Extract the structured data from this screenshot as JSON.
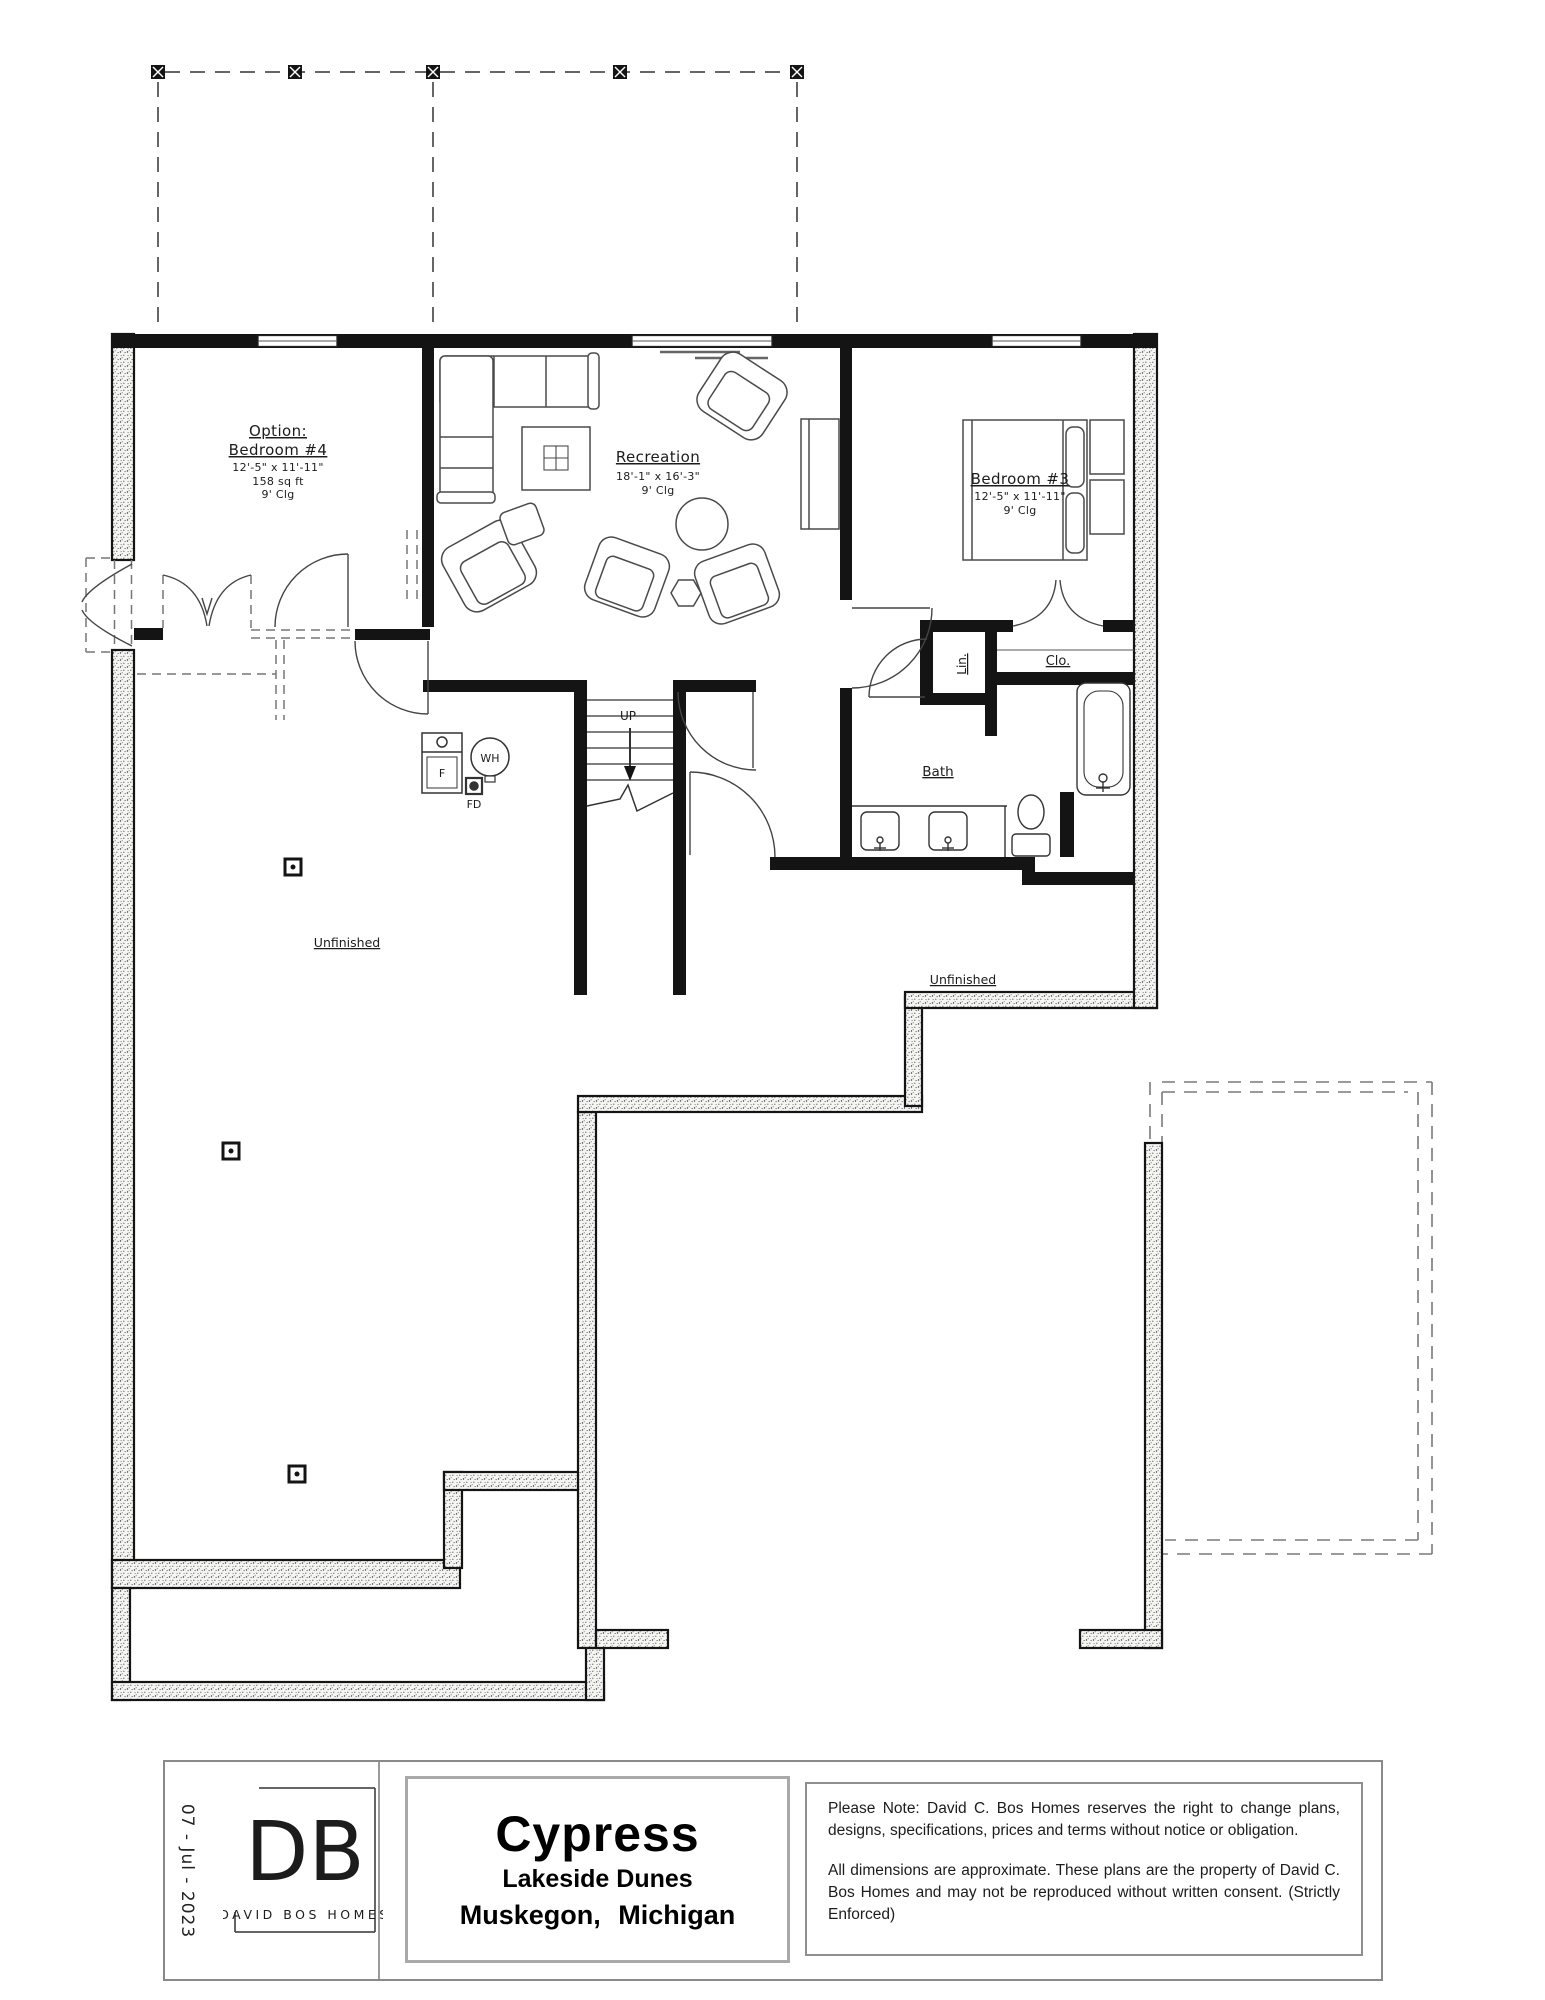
{
  "rooms": {
    "bedroom4": {
      "l1": "Option:",
      "l2": "Bedroom #4",
      "dims": "12'-5\" x 11'-11\"",
      "area": "158 sq ft",
      "ceiling": "9' Clg"
    },
    "recreation": {
      "name": "Recreation",
      "dims": "18'-1\" x 16'-3\"",
      "ceiling": "9' Clg"
    },
    "bedroom3": {
      "name": "Bedroom #3",
      "dims": "12'-5\" x 11'-11\"",
      "ceiling": "9' Clg"
    },
    "bath": {
      "name": "Bath"
    },
    "linen": {
      "name": "Lin."
    },
    "closet": {
      "name": "Clo."
    },
    "unfinished_left": {
      "name": "Unfinished"
    },
    "unfinished_right": {
      "name": "Unfinished"
    }
  },
  "labels": {
    "stairs_up": "UP",
    "furnace": "F",
    "water_heater": "WH",
    "floor_drain": "FD"
  },
  "titleblock": {
    "date": "07 - Jul - 2023",
    "logo_initials": "DB",
    "logo_name": "DAVID BOS HOMES",
    "plan_name": "Cypress",
    "community": "Lakeside Dunes",
    "city": "Muskegon, Michigan",
    "note_1": "Please Note: David C. Bos Homes reserves the right to change plans, designs, specifications, prices and terms without notice or obligation.",
    "note_2": "All dimensions are approximate. These plans are the property of David C. Bos Homes and may not be reproduced without written consent. (Strictly Enforced)"
  },
  "colors": {
    "line": "#141414",
    "dashed": "#777777",
    "furniture": "#4a4a4a",
    "paper": "#ffffff"
  }
}
